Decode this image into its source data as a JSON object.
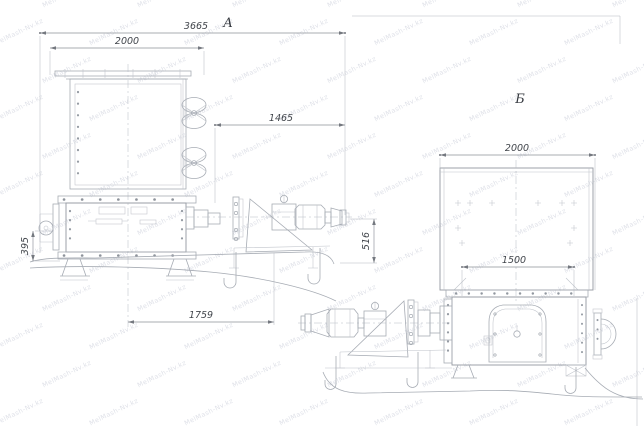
{
  "watermark": {
    "text": "MelMash-Nv.kz",
    "color": "#9aa0b8"
  },
  "colors": {
    "background": "#ffffff",
    "line": "#a7acb4",
    "dim_text": "#41454b"
  },
  "views": [
    {
      "label": "А",
      "dims": [
        {
          "name": "overall-length",
          "value": "3665"
        },
        {
          "name": "hopper-width",
          "value": "2000"
        },
        {
          "name": "drive-length",
          "value": "1465"
        },
        {
          "name": "drive-height",
          "value": "516"
        },
        {
          "name": "frame-height",
          "value": "395"
        },
        {
          "name": "base-span",
          "value": "1759"
        }
      ]
    },
    {
      "label": "Б",
      "dims": [
        {
          "name": "body-width",
          "value": "2000"
        },
        {
          "name": "lower-span",
          "value": "1500"
        }
      ]
    }
  ]
}
